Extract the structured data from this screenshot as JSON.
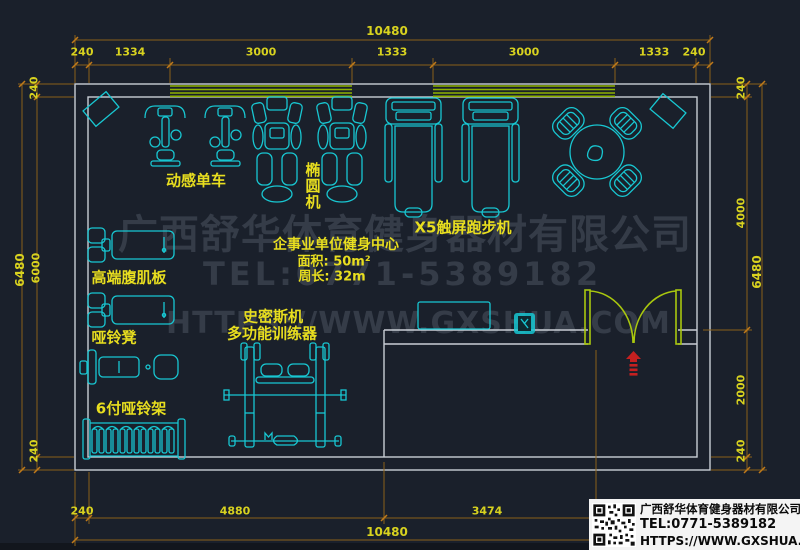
{
  "watermark": {
    "line1": "广西舒华体育健身器材有限公司",
    "line2": "TEL:0771-5389182",
    "line3": "HTTPS://WWW.GXSHUA.COM"
  },
  "room_info": {
    "title": "企事业单位健身中心",
    "area": "面积: 50m²",
    "perimeter": "周长: 32m"
  },
  "equipment_labels": {
    "spin_bike": "动感单车",
    "elliptical": "椭圆机",
    "treadmill": "X5触屏跑步机",
    "ab_board": "高端腹肌板",
    "dumbbell_bench": "哑铃凳",
    "dumbbell_rack": "6付哑铃架",
    "smith_machine": "史密斯机",
    "multi_trainer": "多功能训练器"
  },
  "dimensions": {
    "top": {
      "overall": "10480",
      "segments": [
        "240",
        "1334",
        "3000",
        "1333",
        "3000",
        "1333",
        "240"
      ]
    },
    "bottom": {
      "overall": "10480",
      "segments": [
        "240",
        "4880",
        "3474"
      ]
    },
    "left": {
      "overall": "6480",
      "segments": [
        "240",
        "6000",
        "240"
      ]
    },
    "right": {
      "overall": "6480",
      "segments": [
        "240",
        "4000",
        "2000",
        "240"
      ]
    }
  },
  "footer_card": {
    "company": "广西舒华体育健身器材有限公司",
    "tel": "TEL:0771-5389182",
    "url": "HTTPS://WWW.GXSHUA.COM"
  },
  "colors": {
    "background": "#1a202b",
    "wall": "#c9ced6",
    "equipment": "#18c7d2",
    "dimension_line": "#8a6018",
    "dimension_text": "#d8d21f",
    "label_text": "#e8de1f",
    "window": "#8fb301",
    "door": "#a9c70e",
    "entry_symbol": "#c52020",
    "watermark": "#353c48"
  }
}
